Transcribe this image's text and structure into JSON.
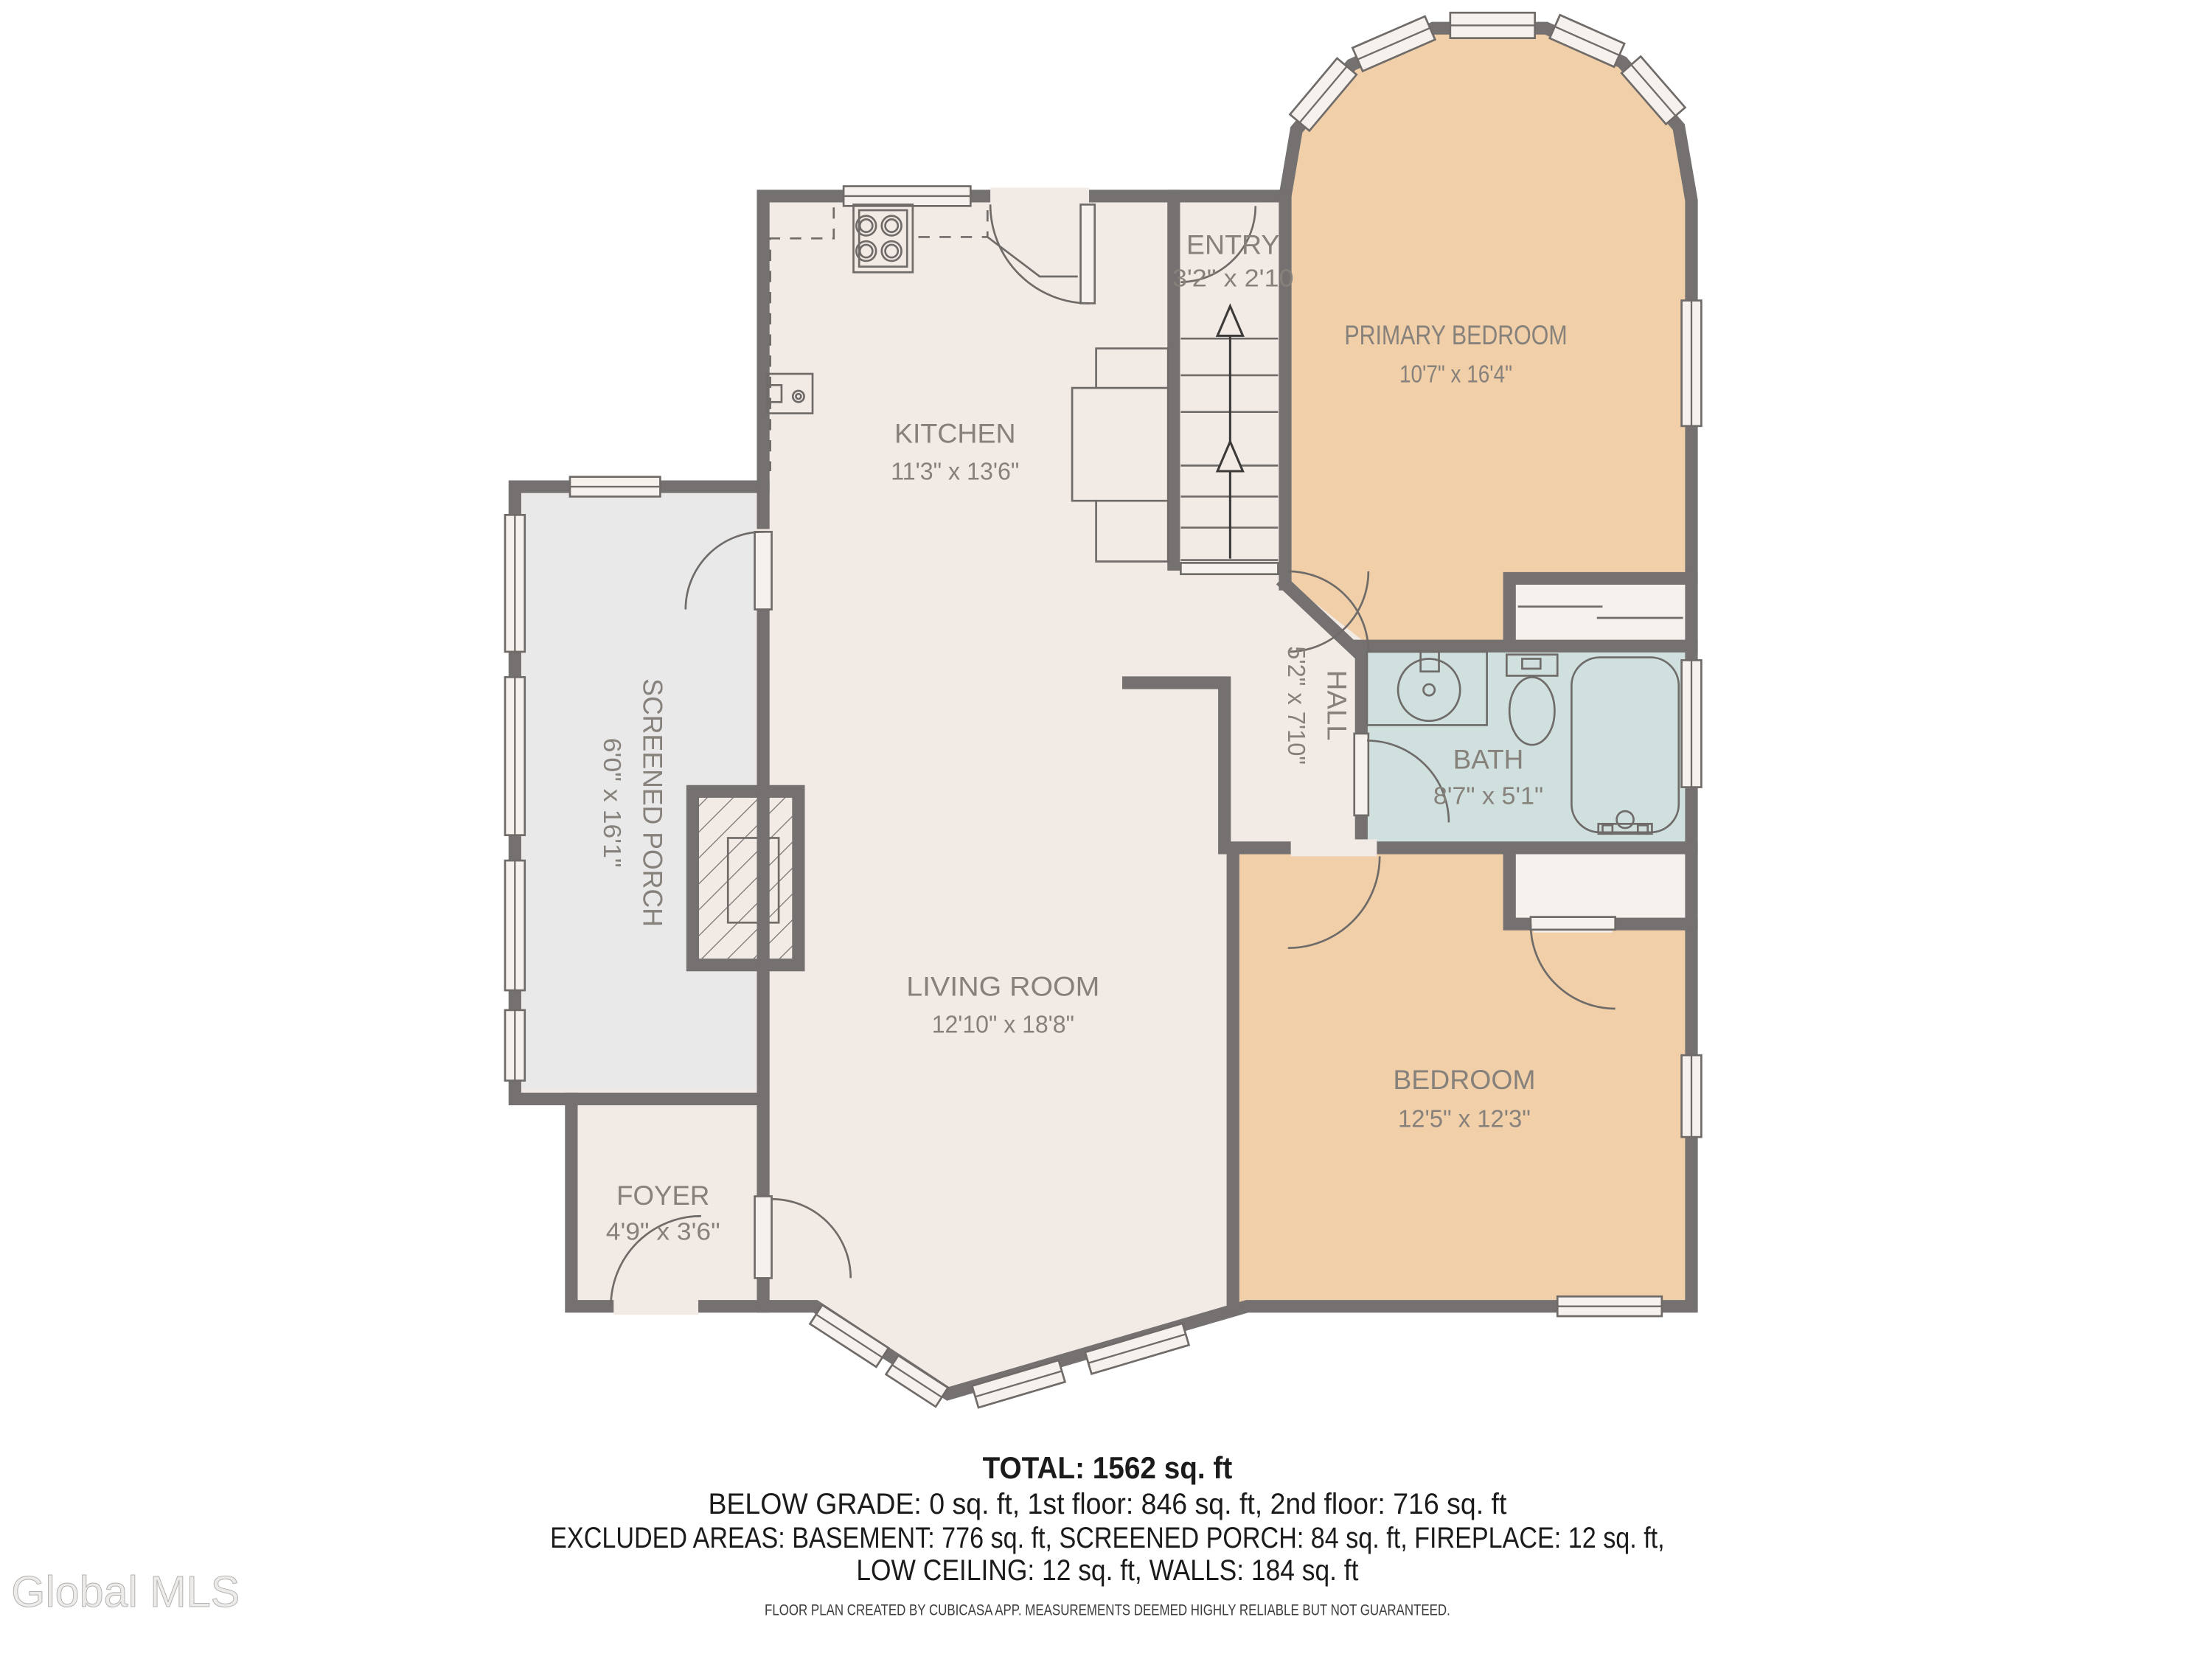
{
  "plan": {
    "rooms": {
      "entry": {
        "name": "ENTRY",
        "dims": "3'2\" x 2'10"
      },
      "primary_bedroom": {
        "name": "PRIMARY BEDROOM",
        "dims": "10'7\" x 16'4\""
      },
      "kitchen": {
        "name": "KITCHEN",
        "dims": "11'3\" x 13'6\""
      },
      "screened_porch": {
        "name": "SCREENED PORCH",
        "dims": "6'0\" x 16'1\""
      },
      "hall": {
        "name": "HALL",
        "dims": "5'2\" x 7'10\""
      },
      "bath": {
        "name": "BATH",
        "dims": "8'7\" x 5'1\""
      },
      "living_room": {
        "name": "LIVING ROOM",
        "dims": "12'10\" x 18'8\""
      },
      "bedroom": {
        "name": "BEDROOM",
        "dims": "12'5\" x 12'3\""
      },
      "foyer": {
        "name": "FOYER",
        "dims": "4'9\" x 3'6\""
      }
    }
  },
  "summary": {
    "total": "TOTAL: 1562 sq. ft",
    "floors": "BELOW GRADE: 0 sq. ft, 1st floor: 846 sq. ft, 2nd floor: 716 sq. ft",
    "excluded": "EXCLUDED AREAS: BASEMENT: 776 sq. ft, SCREENED PORCH: 84 sq. ft, FIREPLACE: 12 sq. ft,",
    "excluded2": "LOW CEILING: 12 sq. ft, WALLS: 184 sq. ft"
  },
  "footer": {
    "disclaimer": "FLOOR PLAN CREATED BY CUBICASA APP. MEASUREMENTS DEEMED HIGHLY RELIABLE BUT NOT GUARANTEED."
  },
  "watermark": {
    "text": "Global MLS"
  },
  "colors": {
    "wall": "#747170",
    "floor": "#f2eae5",
    "bedroom_floor": "#f0cfa9",
    "bath_floor": "#cfe0df",
    "porch_floor": "#e9e9e9",
    "label_text": "#87817b",
    "summary_text": "#1b1b1b"
  }
}
